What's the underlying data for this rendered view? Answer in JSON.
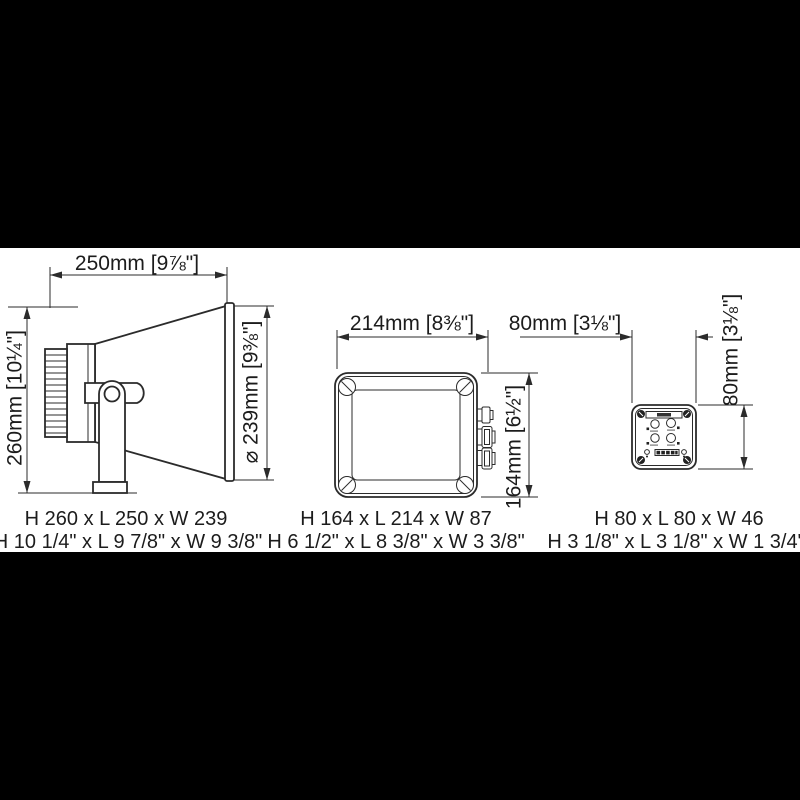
{
  "drawing": {
    "background": "#000000",
    "paper": "#ffffff",
    "line_color": "#2b2b2b",
    "text_color": "#1c1c1c"
  },
  "products": [
    {
      "name": "horn-loudspeaker",
      "dims": {
        "length": "250mm [9⅞\"]",
        "height": "260mm [10¼\"]",
        "diameter": "⌀ 239mm [9⅜\"]"
      },
      "caption_metric": "H 260 x L 250 x W 239",
      "caption_imperial": "H 10 1/4\" x L 9 7/8\" x W 9 3/8\""
    },
    {
      "name": "amplifier-box",
      "dims": {
        "length": "214mm [8⅜\"]",
        "height": "164mm [6½\"]"
      },
      "caption_metric": "H 164 x L 214 x W 87",
      "caption_imperial": "H 6 1/2\" x L 8 3/8\" x W 3 3/8\""
    },
    {
      "name": "control-panel",
      "dims": {
        "length": "80mm [3⅛\"]",
        "height": "80mm [3⅛\"]"
      },
      "caption_metric": "H 80 x L 80 x W 46",
      "caption_imperial": "H 3 1/8\" x L 3 1/8\" x W 1 3/4\""
    }
  ]
}
